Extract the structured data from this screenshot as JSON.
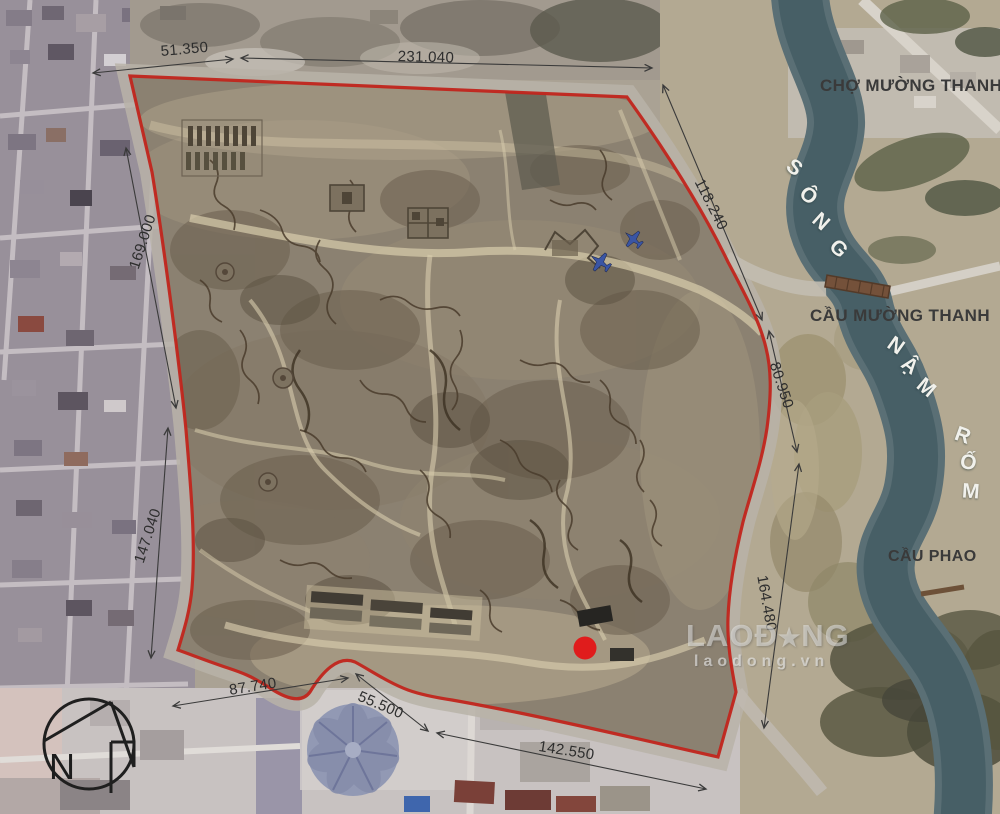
{
  "map": {
    "dimensions": {
      "d51": "51.350",
      "d231": "231.040",
      "d169": "169.000",
      "d147": "147.040",
      "d118": "118.240",
      "d80": "80.950",
      "d164": "164.480",
      "d87": "87.740",
      "d55": "55.500",
      "d142": "142.550"
    },
    "places": {
      "market": "CHỢ MƯỜNG THANH",
      "bridge": "CẦU MƯỜNG THANH",
      "pontoon": "CẦU PHAO"
    },
    "river": {
      "name": "SÔNG NẬM RỐM",
      "letters": [
        "S",
        "Ô",
        "N",
        "G",
        "N",
        "Ậ",
        "M",
        "R",
        "Ố",
        "M"
      ]
    },
    "watermark": {
      "logo_prefix": "LAO",
      "logo_d": "Đ",
      "logo_star": "★",
      "logo_suffix": "NG",
      "url": "laodong.vn"
    },
    "north": {
      "label": "N"
    },
    "colors": {
      "boundary": "#c1251c",
      "marker": "#e01c1c",
      "river": "#475f66",
      "plane": "#3a55a4"
    }
  }
}
